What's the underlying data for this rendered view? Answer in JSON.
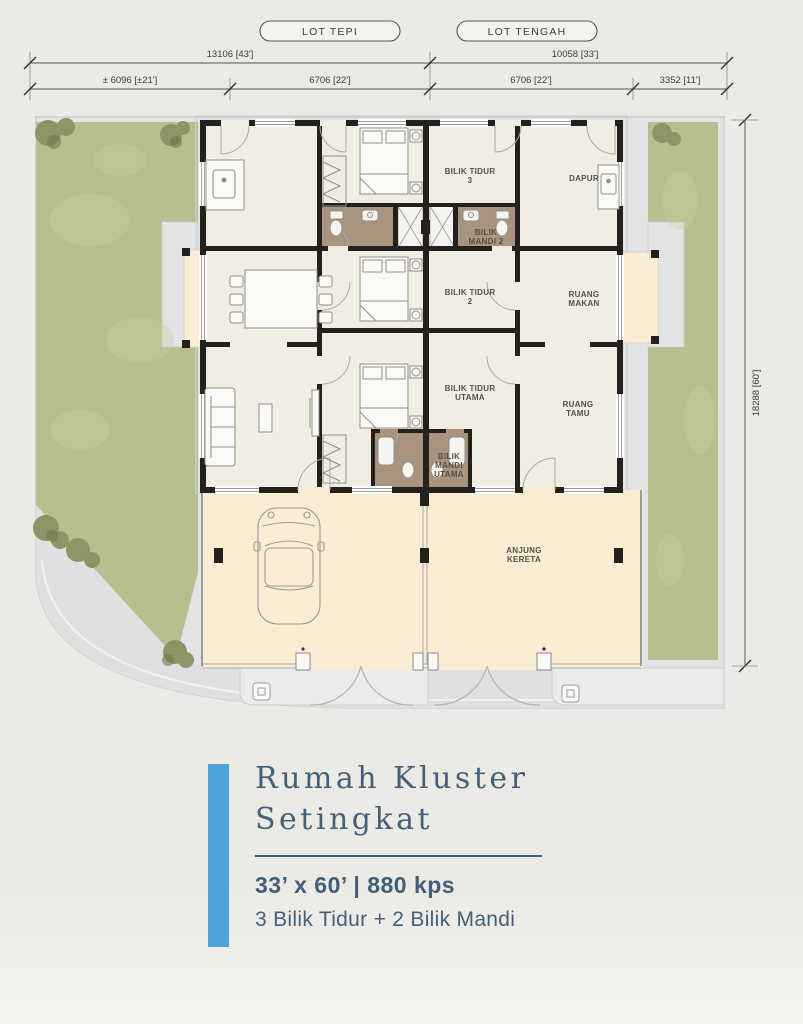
{
  "header": {
    "lot_pills": [
      {
        "label": "LOT TEPI"
      },
      {
        "label": "LOT TENGAH"
      }
    ],
    "dimensions_row1": [
      {
        "value": "13106 [43']"
      },
      {
        "value": "10058 [33']"
      }
    ],
    "dimensions_row2": [
      {
        "value": "± 6096 [±21']"
      },
      {
        "value": "6706 [22']"
      },
      {
        "value": "6706 [22']"
      },
      {
        "value": "3352 [11']"
      }
    ],
    "vertical_dimension": {
      "value": "18288 [60']"
    }
  },
  "plan": {
    "rooms": [
      {
        "id": "bilik-tidur-3",
        "lines": [
          "BILIK TIDUR",
          "3"
        ]
      },
      {
        "id": "dapur",
        "lines": [
          "DAPUR"
        ]
      },
      {
        "id": "bilik-mandi-2",
        "lines": [
          "BILIK",
          "MANDI 2"
        ]
      },
      {
        "id": "bilik-tidur-2",
        "lines": [
          "BILIK TIDUR",
          "2"
        ]
      },
      {
        "id": "ruang-makan",
        "lines": [
          "RUANG",
          "MAKAN"
        ]
      },
      {
        "id": "bilik-tidur-utama",
        "lines": [
          "BILIK TIDUR",
          "UTAMA"
        ]
      },
      {
        "id": "ruang-tamu",
        "lines": [
          "RUANG",
          "TAMU"
        ]
      },
      {
        "id": "bilik-mandi-utama",
        "lines": [
          "BILIK",
          "MANDI",
          "UTAMA"
        ]
      },
      {
        "id": "anjung-kereta",
        "lines": [
          "ANJUNG",
          "KERETA"
        ]
      }
    ]
  },
  "info_card": {
    "title_line_1": "Rumah Kluster",
    "title_line_2": "Setingkat",
    "spec": "33’ x 60’ | 880 kps",
    "features": "3 Bilik Tidur + 2 Bilik Mandi"
  },
  "colors": {
    "accent_blue": "#4FA3DB",
    "heading_slate": "#44617C",
    "grass_green": "#B6C08E",
    "porch_cream": "#FAEDD3",
    "room_floor": "#F1EDE2",
    "bathroom_brown": "#A8937F",
    "wall_dark": "#24211D"
  }
}
